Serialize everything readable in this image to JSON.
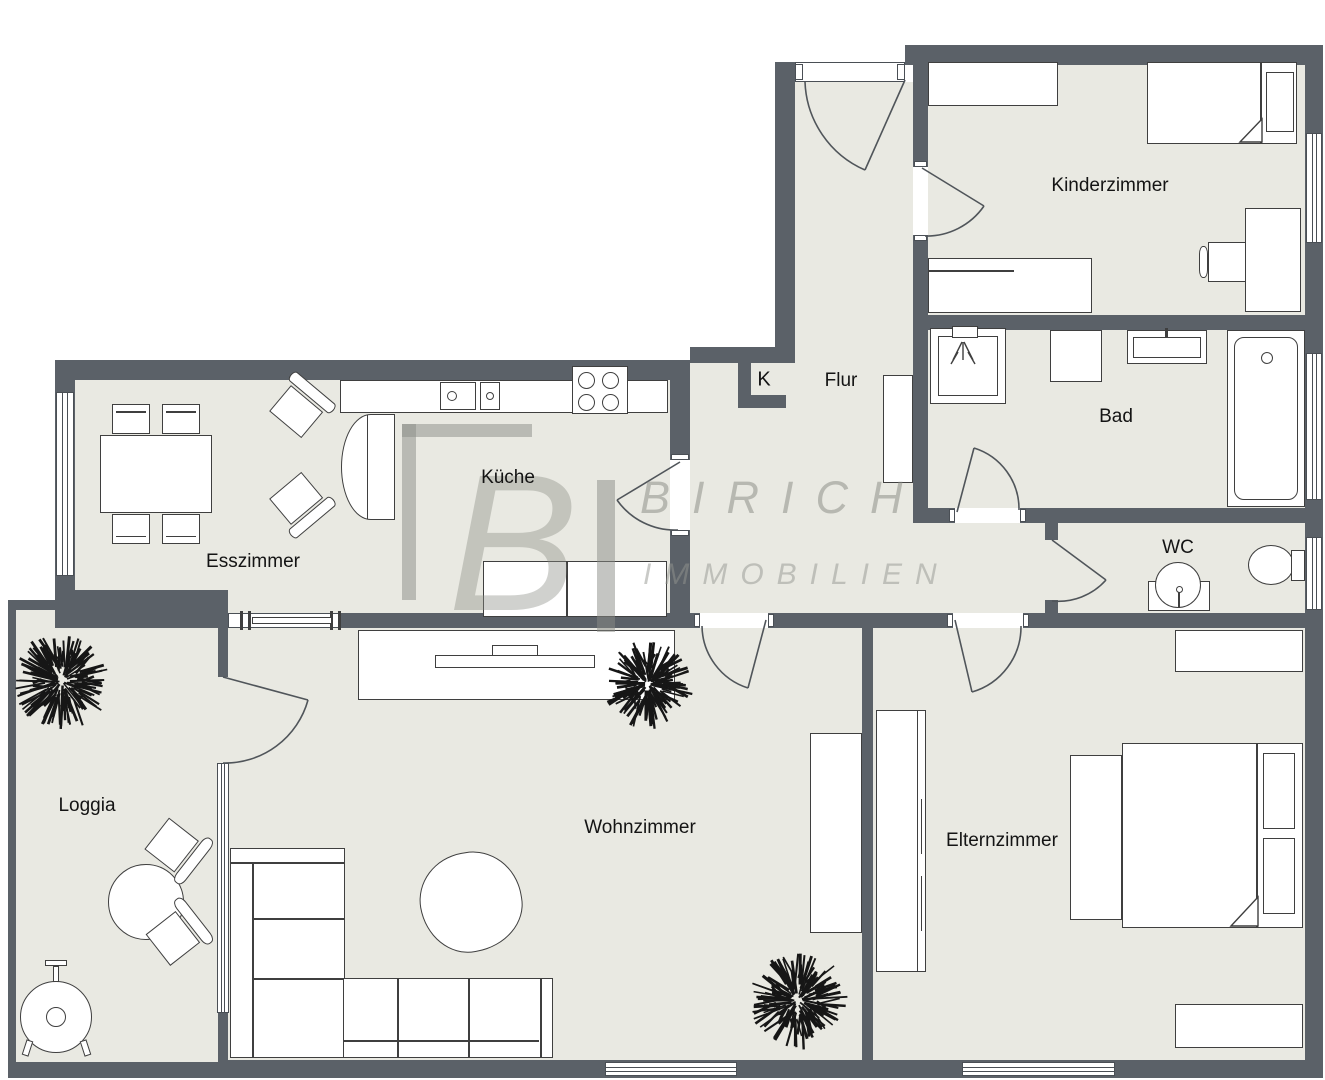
{
  "rooms": {
    "esszimmer": "Esszimmer",
    "kueche": "Küche",
    "flur": "Flur",
    "kammer": "K",
    "kinderzimmer": "Kinderzimmer",
    "bad": "Bad",
    "wc": "WC",
    "loggia": "Loggia",
    "wohnzimmer": "Wohnzimmer",
    "elternzimmer": "Elternzimmer"
  },
  "watermark": {
    "logo_letter": "B",
    "brand": "BIRICH",
    "subtitle": "IMMOBILIEN"
  },
  "colors": {
    "wall": "#5b6168",
    "floor": "#e9e9e2",
    "outline": "#3f3f3f",
    "watermark": "#8a8c85"
  }
}
